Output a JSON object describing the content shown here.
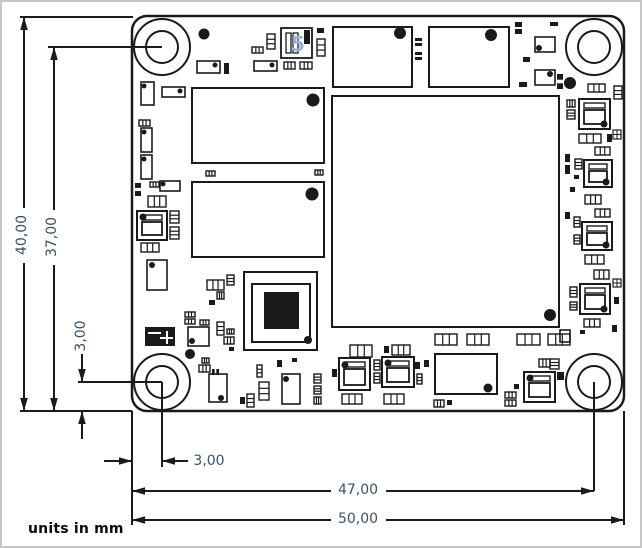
{
  "notes": {
    "units": "units in mm"
  },
  "colors": {
    "line": "#1b1b1b",
    "label": "#3d5168",
    "component": "#1a1a1a",
    "fill": "#ffffff",
    "marking_blue": "#9cb6d2"
  },
  "board": {
    "x": 130,
    "y": 14,
    "width": 492,
    "height": 395,
    "corner_radius": 15,
    "outline_stroke": 2.5,
    "hole_outer_r": 28,
    "hole_inner_r": 16,
    "holes": [
      {
        "name": "mounting-hole-top-left",
        "cx": 160,
        "cy": 45
      },
      {
        "name": "mounting-hole-top-right",
        "cx": 592,
        "cy": 45
      },
      {
        "name": "mounting-hole-bottom-left",
        "cx": 160,
        "cy": 380
      },
      {
        "name": "mounting-hole-bottom-right",
        "cx": 592,
        "cy": 380
      }
    ],
    "ic_marking": "5",
    "components": [
      {
        "t": "chip",
        "x": 190,
        "y": 86,
        "w": 132,
        "h": 75,
        "dot": [
          311,
          98,
          6.5
        ]
      },
      {
        "t": "chip",
        "x": 190,
        "y": 180,
        "w": 132,
        "h": 75,
        "dot": [
          310,
          192,
          6.5
        ]
      },
      {
        "t": "chip",
        "x": 331,
        "y": 25,
        "w": 79,
        "h": 60,
        "dot": [
          398,
          31,
          6
        ]
      },
      {
        "t": "chip",
        "x": 427,
        "y": 25,
        "w": 80,
        "h": 60,
        "dot": [
          489,
          33,
          6
        ]
      },
      {
        "t": "chip",
        "x": 330,
        "y": 94,
        "w": 227,
        "h": 231,
        "dot": [
          548,
          313,
          6
        ]
      },
      {
        "t": "chip",
        "x": 433,
        "y": 352,
        "w": 62,
        "h": 40,
        "dot": [
          486,
          386,
          4.5
        ]
      },
      {
        "t": "qfp",
        "x": 242,
        "y": 270,
        "w": 73,
        "h": 78,
        "inner": [
          250,
          282,
          58,
          58
        ],
        "die": [
          262,
          290,
          35,
          37
        ],
        "dot": [
          306,
          338,
          4
        ]
      },
      {
        "t": "ic5",
        "x": 279,
        "y": 26,
        "w": 31,
        "h": 30
      },
      {
        "t": "switch",
        "x": 143,
        "y": 325,
        "w": 30,
        "h": 19
      },
      {
        "t": "qfn",
        "x": 577,
        "y": 97,
        "w": 31,
        "h": 30,
        "dot": [
          602,
          122,
          3.5
        ]
      },
      {
        "t": "qfn",
        "x": 582,
        "y": 158,
        "w": 28,
        "h": 27,
        "dot": [
          604,
          180,
          3.5
        ]
      },
      {
        "t": "qfn",
        "x": 580,
        "y": 220,
        "w": 30,
        "h": 28,
        "dot": [
          604,
          243,
          3.5
        ]
      },
      {
        "t": "qfn",
        "x": 578,
        "y": 282,
        "w": 30,
        "h": 30,
        "dot": [
          602,
          307,
          3.5
        ]
      },
      {
        "t": "qfn",
        "x": 337,
        "y": 356,
        "w": 31,
        "h": 32,
        "dot": [
          343,
          363,
          3.5
        ]
      },
      {
        "t": "qfn",
        "x": 380,
        "y": 355,
        "w": 32,
        "h": 30,
        "dot": [
          386,
          361,
          3.5
        ]
      },
      {
        "t": "qfn",
        "x": 522,
        "y": 370,
        "w": 31,
        "h": 30,
        "dot": [
          528,
          376,
          3.5
        ]
      },
      {
        "t": "qfn",
        "x": 135,
        "y": 209,
        "w": 30,
        "h": 29,
        "dot": [
          141,
          215,
          3.5
        ]
      },
      {
        "t": "rectdot",
        "x": 186,
        "y": 325,
        "w": 21,
        "h": 19,
        "dot": [
          190,
          339,
          3
        ]
      },
      {
        "t": "rectdot",
        "x": 145,
        "y": 258,
        "w": 20,
        "h": 30,
        "dot": [
          150,
          263,
          3
        ]
      },
      {
        "t": "rectdot",
        "x": 207,
        "y": 372,
        "w": 18,
        "h": 28,
        "dot": [
          219,
          396,
          3
        ]
      },
      {
        "t": "rectdot",
        "x": 280,
        "y": 372,
        "w": 18,
        "h": 30,
        "dot": [
          284,
          377,
          3
        ]
      },
      {
        "t": "rectdot",
        "x": 139,
        "y": 80,
        "w": 13,
        "h": 23,
        "dot": [
          142,
          84,
          2.5
        ]
      },
      {
        "t": "rectdot",
        "x": 160,
        "y": 85,
        "w": 23,
        "h": 10,
        "dot": [
          178,
          89,
          2.5
        ]
      },
      {
        "t": "rectdot",
        "x": 195,
        "y": 59,
        "w": 23,
        "h": 12,
        "dot": [
          213,
          63,
          2.5
        ]
      },
      {
        "t": "rectdot",
        "x": 252,
        "y": 59,
        "w": 23,
        "h": 10,
        "dot": [
          270,
          63,
          2.5
        ]
      },
      {
        "t": "rectdot",
        "x": 139,
        "y": 126,
        "w": 11,
        "h": 24,
        "dot": [
          142,
          130,
          2.5
        ]
      },
      {
        "t": "rectdot",
        "x": 139,
        "y": 153,
        "w": 11,
        "h": 24,
        "dot": [
          142,
          157,
          2.5
        ]
      },
      {
        "t": "rectdot",
        "x": 158,
        "y": 179,
        "w": 20,
        "h": 10,
        "dot": [
          161,
          182,
          2.5
        ]
      },
      {
        "t": "rectdot",
        "x": 533,
        "y": 35,
        "w": 20,
        "h": 15,
        "dot": [
          537,
          46,
          3
        ]
      },
      {
        "t": "rectdot",
        "x": 533,
        "y": 68,
        "w": 20,
        "h": 15,
        "dot": [
          548,
          72,
          3
        ]
      },
      {
        "t": "rect",
        "x": 558,
        "y": 328,
        "w": 10,
        "h": 12
      },
      {
        "t": "via",
        "x": 202,
        "y": 32,
        "r": 5.5
      },
      {
        "t": "via",
        "x": 568,
        "y": 81,
        "r": 6
      },
      {
        "t": "via",
        "x": 188,
        "y": 352,
        "r": 5
      },
      {
        "t": "sqx",
        "x": 611,
        "y": 128,
        "w": 8,
        "h": 9
      },
      {
        "t": "sqx",
        "x": 611,
        "y": 277,
        "w": 8,
        "h": 8
      },
      {
        "t": "capo",
        "x": 250,
        "y": 45,
        "w": 11,
        "h": 6
      },
      {
        "t": "capo",
        "x": 265,
        "y": 32,
        "w": 8,
        "h": 15
      },
      {
        "t": "capo",
        "x": 315,
        "y": 37,
        "w": 8,
        "h": 17
      },
      {
        "t": "capo",
        "x": 282,
        "y": 60,
        "w": 11,
        "h": 7
      },
      {
        "t": "capo",
        "x": 298,
        "y": 60,
        "w": 12,
        "h": 7
      },
      {
        "t": "capo",
        "x": 137,
        "y": 118,
        "w": 11,
        "h": 6
      },
      {
        "t": "capo",
        "x": 146,
        "y": 194,
        "w": 18,
        "h": 11
      },
      {
        "t": "capo",
        "x": 139,
        "y": 241,
        "w": 18,
        "h": 9
      },
      {
        "t": "capo",
        "x": 168,
        "y": 209,
        "w": 9,
        "h": 12
      },
      {
        "t": "capo",
        "x": 168,
        "y": 225,
        "w": 9,
        "h": 12
      },
      {
        "t": "capo",
        "x": 148,
        "y": 180,
        "w": 9,
        "h": 5
      },
      {
        "t": "capo",
        "x": 204,
        "y": 169,
        "w": 9,
        "h": 5
      },
      {
        "t": "capo",
        "x": 313,
        "y": 168,
        "w": 8,
        "h": 5
      },
      {
        "t": "capo",
        "x": 586,
        "y": 82,
        "w": 17,
        "h": 8
      },
      {
        "t": "capo",
        "x": 612,
        "y": 84,
        "w": 8,
        "h": 13
      },
      {
        "t": "capo",
        "x": 577,
        "y": 132,
        "w": 22,
        "h": 9
      },
      {
        "t": "capo",
        "x": 593,
        "y": 145,
        "w": 15,
        "h": 8
      },
      {
        "t": "capo",
        "x": 583,
        "y": 193,
        "w": 16,
        "h": 9
      },
      {
        "t": "capo",
        "x": 593,
        "y": 207,
        "w": 15,
        "h": 8
      },
      {
        "t": "capo",
        "x": 573,
        "y": 157,
        "w": 7,
        "h": 10
      },
      {
        "t": "capo",
        "x": 572,
        "y": 215,
        "w": 6,
        "h": 10
      },
      {
        "t": "capo",
        "x": 572,
        "y": 233,
        "w": 6,
        "h": 9
      },
      {
        "t": "capo",
        "x": 583,
        "y": 253,
        "w": 19,
        "h": 9
      },
      {
        "t": "capo",
        "x": 592,
        "y": 268,
        "w": 15,
        "h": 9
      },
      {
        "t": "capo",
        "x": 568,
        "y": 285,
        "w": 7,
        "h": 10
      },
      {
        "t": "capo",
        "x": 568,
        "y": 300,
        "w": 7,
        "h": 8
      },
      {
        "t": "capo",
        "x": 582,
        "y": 317,
        "w": 16,
        "h": 8
      },
      {
        "t": "capo",
        "x": 565,
        "y": 98,
        "w": 8,
        "h": 7
      },
      {
        "t": "capo",
        "x": 565,
        "y": 108,
        "w": 8,
        "h": 9
      },
      {
        "t": "capo",
        "x": 433,
        "y": 332,
        "w": 22,
        "h": 11
      },
      {
        "t": "capo",
        "x": 465,
        "y": 332,
        "w": 22,
        "h": 11
      },
      {
        "t": "capo",
        "x": 515,
        "y": 332,
        "w": 23,
        "h": 11
      },
      {
        "t": "capo",
        "x": 546,
        "y": 332,
        "w": 22,
        "h": 11
      },
      {
        "t": "capo",
        "x": 348,
        "y": 343,
        "w": 22,
        "h": 12
      },
      {
        "t": "capo",
        "x": 390,
        "y": 343,
        "w": 18,
        "h": 10
      },
      {
        "t": "capo",
        "x": 340,
        "y": 392,
        "w": 20,
        "h": 10
      },
      {
        "t": "capo",
        "x": 382,
        "y": 392,
        "w": 20,
        "h": 10
      },
      {
        "t": "capo",
        "x": 537,
        "y": 357,
        "w": 11,
        "h": 8
      },
      {
        "t": "capo",
        "x": 548,
        "y": 357,
        "w": 9,
        "h": 10
      },
      {
        "t": "capo",
        "x": 432,
        "y": 398,
        "w": 10,
        "h": 7
      },
      {
        "t": "capo",
        "x": 503,
        "y": 390,
        "w": 11,
        "h": 6
      },
      {
        "t": "capo",
        "x": 503,
        "y": 398,
        "w": 11,
        "h": 6
      },
      {
        "t": "capo",
        "x": 205,
        "y": 278,
        "w": 17,
        "h": 10
      },
      {
        "t": "capo",
        "x": 225,
        "y": 273,
        "w": 7,
        "h": 10
      },
      {
        "t": "capo",
        "x": 215,
        "y": 290,
        "w": 7,
        "h": 7
      },
      {
        "t": "capo",
        "x": 183,
        "y": 310,
        "w": 10,
        "h": 5
      },
      {
        "t": "capo",
        "x": 183,
        "y": 317,
        "w": 10,
        "h": 5
      },
      {
        "t": "capo",
        "x": 198,
        "y": 318,
        "w": 9,
        "h": 5
      },
      {
        "t": "capo",
        "x": 215,
        "y": 320,
        "w": 7,
        "h": 13
      },
      {
        "t": "capo",
        "x": 225,
        "y": 327,
        "w": 7,
        "h": 5
      },
      {
        "t": "capo",
        "x": 222,
        "y": 335,
        "w": 10,
        "h": 7
      },
      {
        "t": "capo",
        "x": 197,
        "y": 363,
        "w": 11,
        "h": 7
      },
      {
        "t": "capo",
        "x": 200,
        "y": 356,
        "w": 7,
        "h": 5
      },
      {
        "t": "capo",
        "x": 255,
        "y": 363,
        "w": 5,
        "h": 12
      },
      {
        "t": "capo",
        "x": 257,
        "y": 380,
        "w": 10,
        "h": 18
      },
      {
        "t": "capo",
        "x": 245,
        "y": 392,
        "w": 7,
        "h": 13
      },
      {
        "t": "capo",
        "x": 312,
        "y": 372,
        "w": 7,
        "h": 9
      },
      {
        "t": "capo",
        "x": 312,
        "y": 384,
        "w": 7,
        "h": 8
      },
      {
        "t": "capo",
        "x": 312,
        "y": 395,
        "w": 7,
        "h": 7
      },
      {
        "t": "capo",
        "x": 372,
        "y": 358,
        "w": 6,
        "h": 10
      },
      {
        "t": "capo",
        "x": 372,
        "y": 371,
        "w": 6,
        "h": 10
      },
      {
        "t": "capo",
        "x": 415,
        "y": 372,
        "w": 5,
        "h": 10
      },
      {
        "t": "pad",
        "x": 315,
        "y": 26,
        "w": 7,
        "h": 5
      },
      {
        "t": "pad",
        "x": 222,
        "y": 61,
        "w": 5,
        "h": 11
      },
      {
        "t": "pad",
        "x": 207,
        "y": 298,
        "w": 6,
        "h": 5
      },
      {
        "t": "pad",
        "x": 227,
        "y": 345,
        "w": 5,
        "h": 4
      },
      {
        "t": "pad",
        "x": 238,
        "y": 395,
        "w": 5,
        "h": 7
      },
      {
        "t": "pad",
        "x": 275,
        "y": 358,
        "w": 5,
        "h": 7
      },
      {
        "t": "pad",
        "x": 290,
        "y": 356,
        "w": 5,
        "h": 4
      },
      {
        "t": "pad",
        "x": 330,
        "y": 367,
        "w": 5,
        "h": 8
      },
      {
        "t": "pad",
        "x": 382,
        "y": 344,
        "w": 5,
        "h": 7
      },
      {
        "t": "pad",
        "x": 413,
        "y": 360,
        "w": 5,
        "h": 7
      },
      {
        "t": "pad",
        "x": 422,
        "y": 358,
        "w": 5,
        "h": 7
      },
      {
        "t": "pad",
        "x": 445,
        "y": 398,
        "w": 5,
        "h": 5
      },
      {
        "t": "pad",
        "x": 512,
        "y": 382,
        "w": 5,
        "h": 5
      },
      {
        "t": "pad",
        "x": 555,
        "y": 370,
        "w": 7,
        "h": 8
      },
      {
        "t": "pad",
        "x": 563,
        "y": 152,
        "w": 5,
        "h": 8
      },
      {
        "t": "pad",
        "x": 563,
        "y": 163,
        "w": 5,
        "h": 9
      },
      {
        "t": "pad",
        "x": 563,
        "y": 210,
        "w": 5,
        "h": 7
      },
      {
        "t": "pad",
        "x": 568,
        "y": 185,
        "w": 5,
        "h": 5
      },
      {
        "t": "pad",
        "x": 572,
        "y": 173,
        "w": 5,
        "h": 4
      },
      {
        "t": "pad",
        "x": 605,
        "y": 132,
        "w": 5,
        "h": 8
      },
      {
        "t": "pad",
        "x": 610,
        "y": 323,
        "w": 5,
        "h": 7
      },
      {
        "t": "pad",
        "x": 612,
        "y": 295,
        "w": 5,
        "h": 7
      },
      {
        "t": "pad",
        "x": 578,
        "y": 328,
        "w": 5,
        "h": 4
      },
      {
        "t": "pad",
        "x": 548,
        "y": 20,
        "w": 8,
        "h": 4
      },
      {
        "t": "pad",
        "x": 521,
        "y": 55,
        "w": 7,
        "h": 5
      },
      {
        "t": "pad",
        "x": 517,
        "y": 80,
        "w": 8,
        "h": 5
      },
      {
        "t": "pad",
        "x": 513,
        "y": 20,
        "w": 7,
        "h": 5
      },
      {
        "t": "pad",
        "x": 513,
        "y": 27,
        "w": 7,
        "h": 5
      },
      {
        "t": "tinypair",
        "x": 133,
        "y": 181,
        "w": 6,
        "h": 13
      },
      {
        "t": "tinypair",
        "x": 555,
        "y": 72,
        "w": 6,
        "h": 15
      },
      {
        "t": "tinypair",
        "x": 413,
        "y": 36,
        "w": 7,
        "h": 8
      },
      {
        "t": "tinypair",
        "x": 413,
        "y": 50,
        "w": 7,
        "h": 8
      },
      {
        "t": "tinypair",
        "x": 210,
        "y": 367,
        "w": 7,
        "h": 6
      }
    ]
  },
  "dimensions": [
    {
      "id": "overall-height",
      "label": "40,00",
      "type": "inside",
      "orientation": "vertical",
      "x": 22,
      "from": 15,
      "to": 409,
      "gap": [
        206,
        261
      ],
      "label_cx": 20,
      "label_cy": 233,
      "rotated": true
    },
    {
      "id": "hole-height",
      "label": "37,00",
      "type": "inside",
      "orientation": "vertical",
      "x": 52,
      "from": 45,
      "to": 409,
      "gap": [
        208,
        263
      ],
      "label_cx": 50,
      "label_cy": 235,
      "rotated": true
    },
    {
      "id": "hole-offset-vertical",
      "label": "3,00",
      "type": "outside",
      "arrows": [
        {
          "x": 80,
          "y": 380,
          "dir": "down",
          "stem": 352
        },
        {
          "x": 80,
          "y": 409,
          "dir": "up",
          "stem": 437
        }
      ],
      "label_cx": 79,
      "label_cy": 334,
      "rotated": true
    },
    {
      "id": "hole-offset-horizontal",
      "label": "3,00",
      "type": "outside",
      "arrows": [
        {
          "x": 130,
          "y": 459,
          "dir": "right",
          "stem": 102
        },
        {
          "x": 160,
          "y": 459,
          "dir": "left",
          "stem": 186
        }
      ],
      "label_cx": 207,
      "label_cy": 459,
      "rotated": false
    },
    {
      "id": "hole-width",
      "label": "47,00",
      "type": "inside",
      "orientation": "horizontal",
      "y": 489,
      "from": 130,
      "to": 592,
      "gap": [
        329,
        384
      ],
      "label_cx": 356,
      "label_cy": 488,
      "rotated": false
    },
    {
      "id": "overall-width",
      "label": "50,00",
      "type": "inside",
      "orientation": "horizontal",
      "y": 518,
      "from": 130,
      "to": 622,
      "gap": [
        329,
        384
      ],
      "label_cx": 356,
      "label_cy": 517,
      "rotated": false
    }
  ],
  "extension_lines": [
    [
      18,
      15,
      131,
      15
    ],
    [
      46,
      45,
      160,
      45
    ],
    [
      18,
      409,
      130,
      409
    ],
    [
      76,
      380,
      160,
      380
    ],
    [
      160,
      380,
      160,
      465
    ],
    [
      592,
      380,
      592,
      489
    ],
    [
      130,
      409,
      130,
      523
    ],
    [
      622,
      409,
      622,
      523
    ]
  ]
}
